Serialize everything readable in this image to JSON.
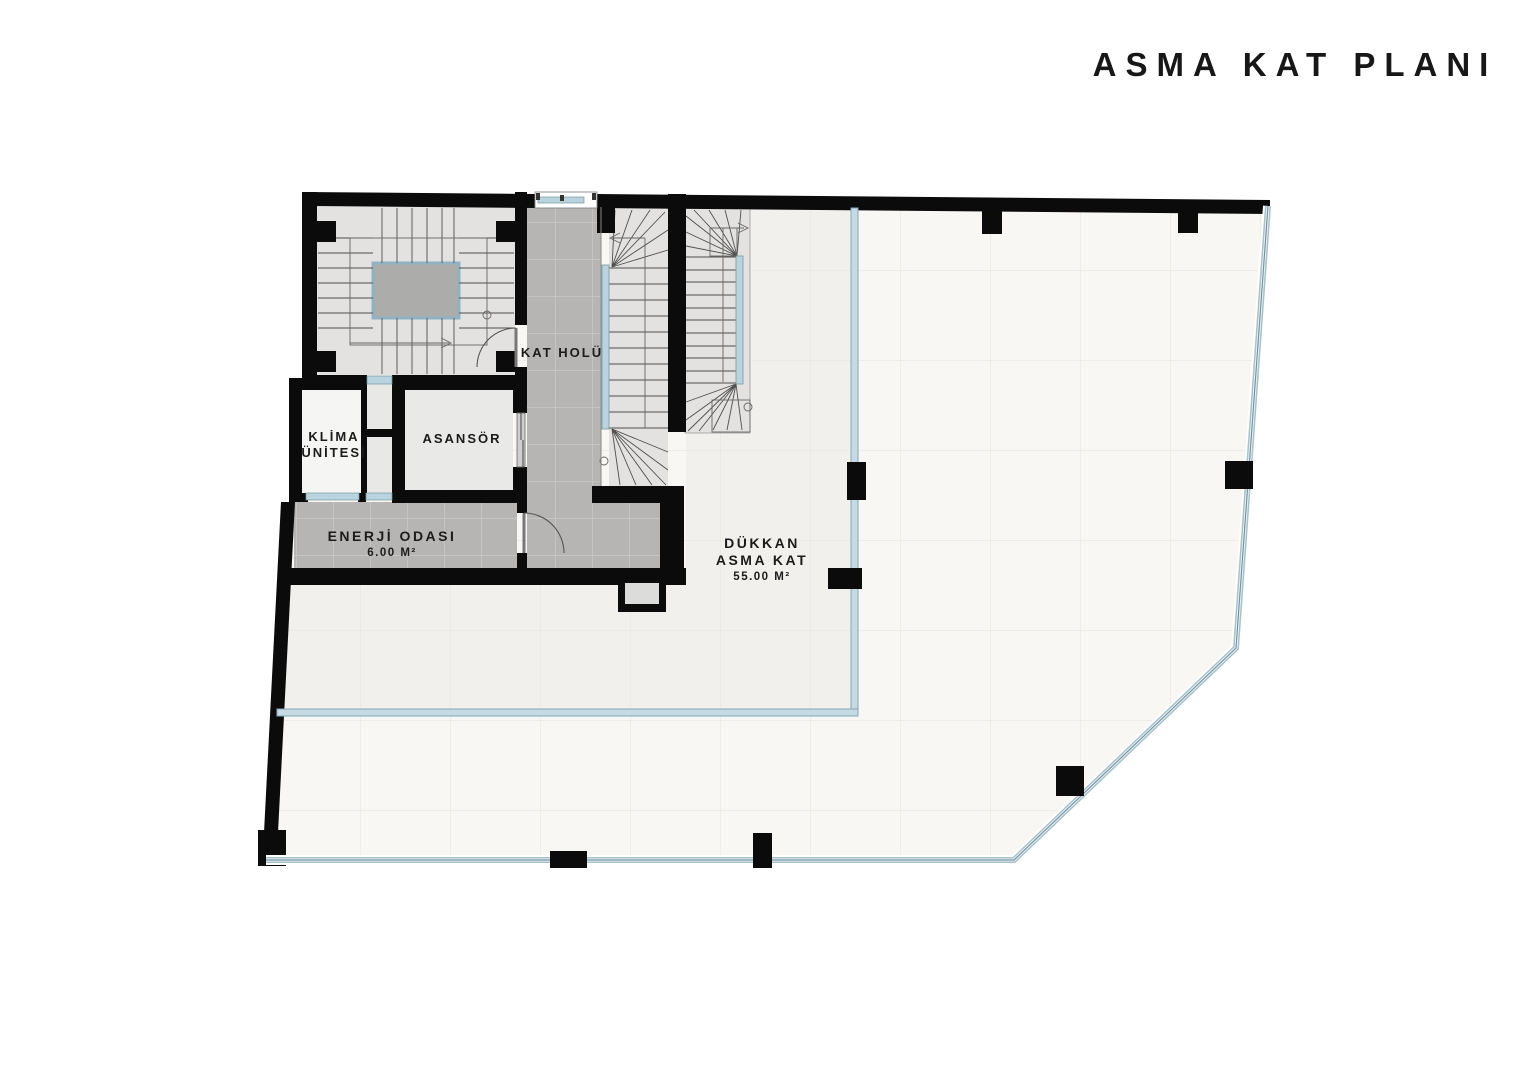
{
  "title": "ASMA KAT PLANI",
  "plan": {
    "rooms": {
      "kat_holu": "KAT HOLÜ",
      "asansor": "ASANSÖR",
      "klima_line1": "KLİMA",
      "klima_line2": "ÜNİTESİ",
      "enerji_line1": "ENERJİ ODASI",
      "enerji_area": "6.00 M²",
      "dukkan_line1": "DÜKKAN",
      "dukkan_line2": "ASMA KAT",
      "dukkan_area": "55.00 M²"
    },
    "colors": {
      "wall": "#0b0b0b",
      "tile_gray": "#b6b5b3",
      "stair_floor": "#e3e2e1",
      "landing_gray": "#acacab",
      "glass_fill": "#b9d3df",
      "glass_edge": "#7793a0",
      "floor_mezzanine": "#f2f0ed",
      "floor_void": "#f8f7f4",
      "text": "#1b1b1b"
    }
  }
}
